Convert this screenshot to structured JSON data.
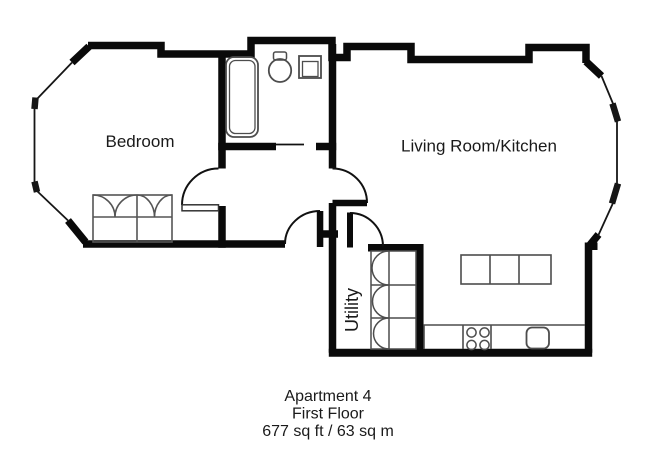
{
  "floorplan": {
    "rooms": {
      "bedroom": {
        "label": "Bedroom"
      },
      "living_kitchen": {
        "label": "Living Room/Kitchen"
      },
      "utility": {
        "label": "Utility"
      }
    },
    "caption": {
      "line1": "Apartment 4",
      "line2": "First Floor",
      "line3": "677 sq ft / 63 sq m"
    },
    "colors": {
      "wall": "#0a0a0a",
      "fixture_line": "#4d4d4d",
      "text": "#1a1a1a",
      "background": "#ffffff"
    },
    "fixtures": [
      "bathtub",
      "toilet",
      "basin",
      "wardrobe",
      "bedroom-door",
      "bathroom-door",
      "living-room-door",
      "entrance-door",
      "utility-door",
      "utility-cupboard",
      "kitchen-island",
      "kitchen-counter",
      "hob",
      "kitchen-sink",
      "bay-window-left",
      "bay-window-right"
    ]
  }
}
